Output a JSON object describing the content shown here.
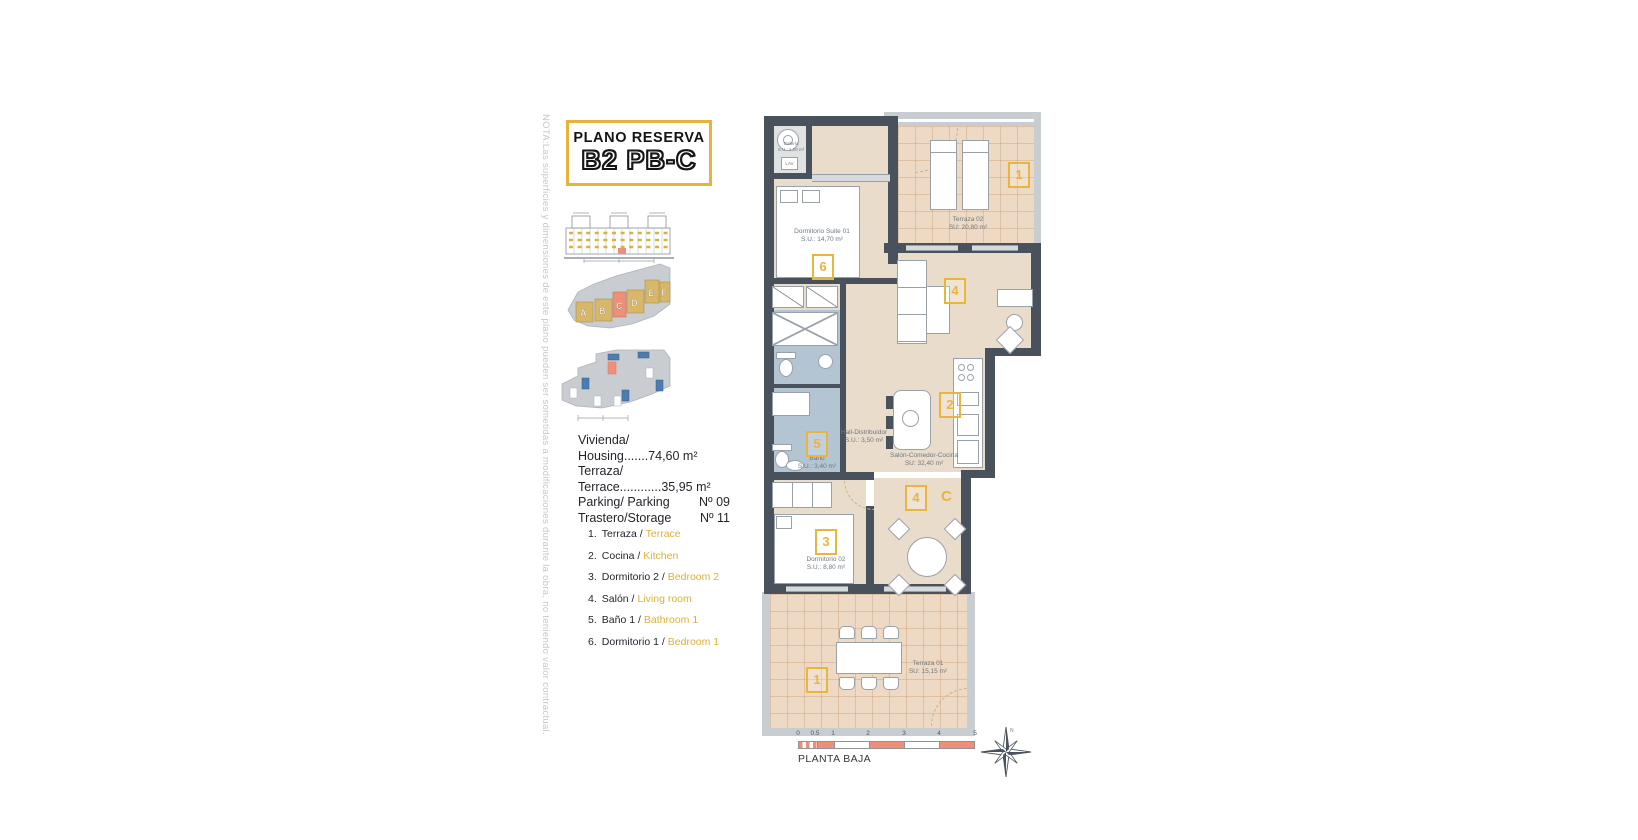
{
  "note": "NOTA:Las superficies y dimensiones de este plano pueden ser sometidas a modificaciones durante la obra, no teniendo valor contractual.",
  "title": {
    "kicker": "PLANO RESERVA",
    "code": "B2 PB-C"
  },
  "site": {
    "sotano": "SÓTANO",
    "blocks": [
      "A",
      "B",
      "C",
      "D",
      "E",
      "F"
    ]
  },
  "info": {
    "rows": [
      {
        "left": "Vivienda/ Housing.......74,60 m²",
        "right": ""
      },
      {
        "left": "Terraza/ Terrace............35,95 m²",
        "right": ""
      },
      {
        "left": "Parking/ Parking",
        "right": "Nº 09"
      },
      {
        "left": "Trastero/Storage",
        "right": "Nº 11"
      }
    ]
  },
  "legend": [
    {
      "num": "1.",
      "es": "Terraza /",
      "en": "Terrace"
    },
    {
      "num": "2.",
      "es": "Cocina /",
      "en": "Kitchen"
    },
    {
      "num": "3.",
      "es": "Dormitorio 2 /",
      "en": "Bedroom 2"
    },
    {
      "num": "4.",
      "es": "Salón /",
      "en": "Living room"
    },
    {
      "num": "5.",
      "es": "Baño 1 /",
      "en": "Bathroom 1"
    },
    {
      "num": "6.",
      "es": "Dormitorio 1 /",
      "en": "Bedroom 1"
    }
  ],
  "plan": {
    "rooms": {
      "galeria": {
        "name": "Galería",
        "area": "S.U.: 1,00 m²",
        "lav": "LAV"
      },
      "suite": {
        "name": "Dormitorio Suite 01",
        "area": "S.U.: 14,70 m²",
        "tag": "6"
      },
      "terraza02": {
        "name": "Terraza 02",
        "area": "SU: 20,80 m²",
        "tag": "1"
      },
      "salon": {
        "name": "Salón-Comedor-Cocina",
        "area": "SU: 32,40 m²",
        "tag": "4",
        "tag_kitchen": "2"
      },
      "hall": {
        "name": "Hall-Distribuidor",
        "area": "S.U.: 3,50 m²"
      },
      "bano": {
        "name": "Baño",
        "area": "S.U.: 3,40 m²",
        "tag": "5"
      },
      "dormitorio02": {
        "name": "Dormitorio 02",
        "area": "S.U.: 8,80 m²",
        "tag": "3"
      },
      "comedor": {
        "tag": "4",
        "section": "C"
      },
      "terraza01": {
        "name": "Terraza 01",
        "area": "SU: 15,15 m²",
        "tag": "1"
      }
    },
    "scale": {
      "ticks": [
        "0",
        "0.5",
        "1",
        "2",
        "3",
        "4",
        "5"
      ],
      "caption": "PLANTA BAJA"
    },
    "compass": {
      "north": "N"
    }
  },
  "colors": {
    "accent": "#E9B53C",
    "wall": "#49525C",
    "floor": "#EADCCB",
    "terrace": "#EDD9C4",
    "bath": "#B3C5D3",
    "highlight": "#EF8F79",
    "english_text": "#D9B13B"
  }
}
